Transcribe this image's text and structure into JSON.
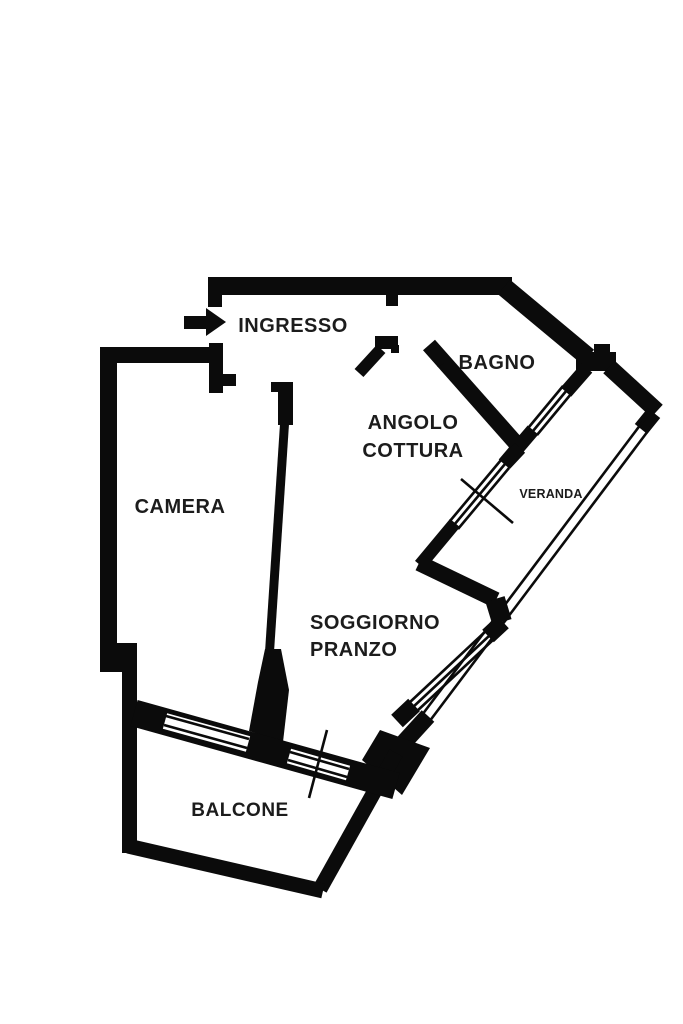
{
  "plan": {
    "type": "apartment-floor-plan",
    "labels": {
      "ingresso": "INGRESSO",
      "bagno": "BAGNO",
      "angolo_cottura_line1": "ANGOLO",
      "angolo_cottura_line2": "COTTURA",
      "camera": "CAMERA",
      "veranda": "VERANDA",
      "soggiorno_line1": "SOGGIORNO",
      "soggiorno_line2": "PRANZO",
      "balcone": "BALCONE"
    },
    "colors": {
      "walls": "#0b0b0b",
      "background": "#ffffff",
      "labels": "#1c1c1c"
    },
    "icons": {
      "entrance_arrow": "right-arrow"
    }
  }
}
